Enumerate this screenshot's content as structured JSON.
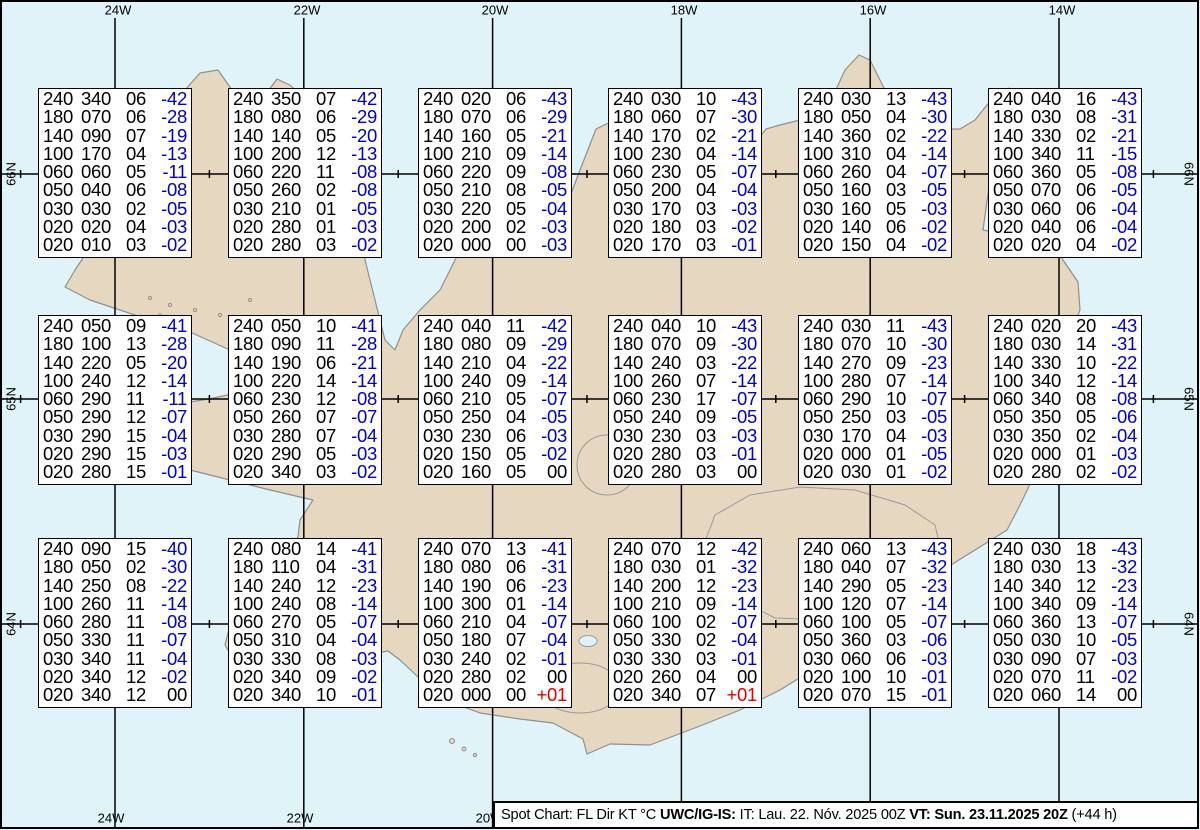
{
  "map": {
    "region_name": "iceland",
    "top_longitude_labels": [
      {
        "text": "24W",
        "x": 118
      },
      {
        "text": "22W",
        "x": 307
      },
      {
        "text": "20W",
        "x": 495
      },
      {
        "text": "18W",
        "x": 684
      },
      {
        "text": "16W",
        "x": 873
      },
      {
        "text": "14W",
        "x": 1062
      }
    ],
    "bottom_longitude_labels": [
      {
        "text": "24W",
        "x": 111
      },
      {
        "text": "22W",
        "x": 300
      },
      {
        "text": "20W",
        "x": 489
      }
    ],
    "left_latitude_labels": [
      {
        "text": "66N",
        "y": 174
      },
      {
        "text": "65N",
        "y": 399
      },
      {
        "text": "64N",
        "y": 624
      }
    ],
    "right_latitude_labels": [
      {
        "text": "66N",
        "y": 174
      },
      {
        "text": "65N",
        "y": 399
      },
      {
        "text": "64N",
        "y": 624
      }
    ],
    "colors": {
      "ocean": "#E0F3F9",
      "land": "#E6D7C1",
      "coastline": "#8F8F8F",
      "grid": "#000000",
      "temp_negative": "#0000CC",
      "temp_positive": "#E00000",
      "text": "#000000"
    }
  },
  "columns_legend": [
    "FL",
    "Dir",
    "KT",
    "°C"
  ],
  "boxes": [
    {
      "col": 0,
      "row": 0,
      "lines": [
        [
          "240",
          "340",
          "06",
          "-42"
        ],
        [
          "180",
          "070",
          "06",
          "-28"
        ],
        [
          "140",
          "090",
          "07",
          "-19"
        ],
        [
          "100",
          "170",
          "04",
          "-13"
        ],
        [
          "060",
          "060",
          "05",
          "-11"
        ],
        [
          "050",
          "040",
          "06",
          "-08"
        ],
        [
          "030",
          "030",
          "02",
          "-05"
        ],
        [
          "020",
          "020",
          "04",
          "-03"
        ],
        [
          "020",
          "010",
          "03",
          "-02"
        ]
      ]
    },
    {
      "col": 1,
      "row": 0,
      "lines": [
        [
          "240",
          "350",
          "07",
          "-42"
        ],
        [
          "180",
          "080",
          "06",
          "-29"
        ],
        [
          "140",
          "140",
          "05",
          "-20"
        ],
        [
          "100",
          "200",
          "12",
          "-13"
        ],
        [
          "060",
          "220",
          "11",
          "-08"
        ],
        [
          "050",
          "260",
          "02",
          "-08"
        ],
        [
          "030",
          "210",
          "01",
          "-05"
        ],
        [
          "020",
          "280",
          "01",
          "-03"
        ],
        [
          "020",
          "280",
          "03",
          "-02"
        ]
      ]
    },
    {
      "col": 2,
      "row": 0,
      "lines": [
        [
          "240",
          "020",
          "06",
          "-43"
        ],
        [
          "180",
          "070",
          "06",
          "-29"
        ],
        [
          "140",
          "160",
          "05",
          "-21"
        ],
        [
          "100",
          "210",
          "09",
          "-14"
        ],
        [
          "060",
          "220",
          "09",
          "-08"
        ],
        [
          "050",
          "210",
          "08",
          "-05"
        ],
        [
          "030",
          "220",
          "05",
          "-04"
        ],
        [
          "020",
          "200",
          "02",
          "-03"
        ],
        [
          "020",
          "000",
          "00",
          "-03"
        ]
      ]
    },
    {
      "col": 3,
      "row": 0,
      "lines": [
        [
          "240",
          "030",
          "10",
          "-43"
        ],
        [
          "180",
          "060",
          "07",
          "-30"
        ],
        [
          "140",
          "170",
          "02",
          "-21"
        ],
        [
          "100",
          "230",
          "04",
          "-14"
        ],
        [
          "060",
          "230",
          "05",
          "-07"
        ],
        [
          "050",
          "200",
          "04",
          "-04"
        ],
        [
          "030",
          "170",
          "03",
          "-03"
        ],
        [
          "020",
          "180",
          "03",
          "-02"
        ],
        [
          "020",
          "170",
          "03",
          "-01"
        ]
      ]
    },
    {
      "col": 4,
      "row": 0,
      "lines": [
        [
          "240",
          "030",
          "13",
          "-43"
        ],
        [
          "180",
          "050",
          "04",
          "-30"
        ],
        [
          "140",
          "360",
          "02",
          "-22"
        ],
        [
          "100",
          "310",
          "04",
          "-14"
        ],
        [
          "060",
          "260",
          "04",
          "-07"
        ],
        [
          "050",
          "160",
          "03",
          "-05"
        ],
        [
          "030",
          "160",
          "05",
          "-03"
        ],
        [
          "020",
          "140",
          "06",
          "-02"
        ],
        [
          "020",
          "150",
          "04",
          "-02"
        ]
      ]
    },
    {
      "col": 5,
      "row": 0,
      "lines": [
        [
          "240",
          "040",
          "16",
          "-43"
        ],
        [
          "180",
          "030",
          "08",
          "-31"
        ],
        [
          "140",
          "330",
          "02",
          "-21"
        ],
        [
          "100",
          "340",
          "11",
          "-15"
        ],
        [
          "060",
          "360",
          "05",
          "-08"
        ],
        [
          "050",
          "070",
          "06",
          "-05"
        ],
        [
          "030",
          "060",
          "06",
          "-04"
        ],
        [
          "020",
          "040",
          "06",
          "-04"
        ],
        [
          "020",
          "020",
          "04",
          "-02"
        ]
      ]
    },
    {
      "col": 0,
      "row": 1,
      "lines": [
        [
          "240",
          "050",
          "09",
          "-41"
        ],
        [
          "180",
          "100",
          "13",
          "-28"
        ],
        [
          "140",
          "220",
          "05",
          "-20"
        ],
        [
          "100",
          "240",
          "12",
          "-14"
        ],
        [
          "060",
          "290",
          "11",
          "-11"
        ],
        [
          "050",
          "290",
          "12",
          "-07"
        ],
        [
          "030",
          "290",
          "15",
          "-04"
        ],
        [
          "020",
          "290",
          "15",
          "-03"
        ],
        [
          "020",
          "280",
          "15",
          "-01"
        ]
      ]
    },
    {
      "col": 1,
      "row": 1,
      "lines": [
        [
          "240",
          "050",
          "10",
          "-41"
        ],
        [
          "180",
          "090",
          "11",
          "-28"
        ],
        [
          "140",
          "190",
          "06",
          "-21"
        ],
        [
          "100",
          "220",
          "14",
          "-14"
        ],
        [
          "060",
          "230",
          "12",
          "-08"
        ],
        [
          "050",
          "260",
          "07",
          "-07"
        ],
        [
          "030",
          "280",
          "07",
          "-04"
        ],
        [
          "020",
          "290",
          "05",
          "-03"
        ],
        [
          "020",
          "340",
          "03",
          "-02"
        ]
      ]
    },
    {
      "col": 2,
      "row": 1,
      "lines": [
        [
          "240",
          "040",
          "11",
          "-42"
        ],
        [
          "180",
          "080",
          "09",
          "-29"
        ],
        [
          "140",
          "210",
          "04",
          "-22"
        ],
        [
          "100",
          "240",
          "09",
          "-14"
        ],
        [
          "060",
          "210",
          "05",
          "-07"
        ],
        [
          "050",
          "250",
          "04",
          "-05"
        ],
        [
          "030",
          "230",
          "06",
          "-03"
        ],
        [
          "020",
          "150",
          "05",
          "-02"
        ],
        [
          "020",
          "160",
          "05",
          "00"
        ]
      ]
    },
    {
      "col": 3,
      "row": 1,
      "lines": [
        [
          "240",
          "040",
          "10",
          "-43"
        ],
        [
          "180",
          "070",
          "09",
          "-30"
        ],
        [
          "140",
          "240",
          "03",
          "-22"
        ],
        [
          "100",
          "260",
          "07",
          "-14"
        ],
        [
          "060",
          "230",
          "17",
          "-07"
        ],
        [
          "050",
          "240",
          "09",
          "-05"
        ],
        [
          "030",
          "230",
          "03",
          "-03"
        ],
        [
          "020",
          "280",
          "03",
          "-01"
        ],
        [
          "020",
          "280",
          "03",
          "00"
        ]
      ]
    },
    {
      "col": 4,
      "row": 1,
      "lines": [
        [
          "240",
          "030",
          "11",
          "-43"
        ],
        [
          "180",
          "070",
          "10",
          "-30"
        ],
        [
          "140",
          "270",
          "09",
          "-23"
        ],
        [
          "100",
          "280",
          "07",
          "-14"
        ],
        [
          "060",
          "290",
          "10",
          "-07"
        ],
        [
          "050",
          "250",
          "03",
          "-05"
        ],
        [
          "030",
          "170",
          "04",
          "-03"
        ],
        [
          "020",
          "000",
          "01",
          "-05"
        ],
        [
          "020",
          "030",
          "01",
          "-02"
        ]
      ]
    },
    {
      "col": 5,
      "row": 1,
      "lines": [
        [
          "240",
          "020",
          "20",
          "-43"
        ],
        [
          "180",
          "030",
          "14",
          "-31"
        ],
        [
          "140",
          "330",
          "10",
          "-22"
        ],
        [
          "100",
          "340",
          "12",
          "-14"
        ],
        [
          "060",
          "340",
          "08",
          "-08"
        ],
        [
          "050",
          "350",
          "05",
          "-06"
        ],
        [
          "030",
          "350",
          "02",
          "-04"
        ],
        [
          "020",
          "000",
          "01",
          "-03"
        ],
        [
          "020",
          "280",
          "02",
          "-02"
        ]
      ]
    },
    {
      "col": 0,
      "row": 2,
      "lines": [
        [
          "240",
          "090",
          "15",
          "-40"
        ],
        [
          "180",
          "050",
          "02",
          "-30"
        ],
        [
          "140",
          "250",
          "08",
          "-22"
        ],
        [
          "100",
          "260",
          "11",
          "-14"
        ],
        [
          "060",
          "280",
          "11",
          "-08"
        ],
        [
          "050",
          "330",
          "11",
          "-07"
        ],
        [
          "030",
          "340",
          "11",
          "-04"
        ],
        [
          "020",
          "340",
          "12",
          "-02"
        ],
        [
          "020",
          "340",
          "12",
          "00"
        ]
      ]
    },
    {
      "col": 1,
      "row": 2,
      "lines": [
        [
          "240",
          "080",
          "14",
          "-41"
        ],
        [
          "180",
          "110",
          "04",
          "-31"
        ],
        [
          "140",
          "240",
          "12",
          "-23"
        ],
        [
          "100",
          "240",
          "08",
          "-14"
        ],
        [
          "060",
          "270",
          "05",
          "-07"
        ],
        [
          "050",
          "310",
          "04",
          "-04"
        ],
        [
          "030",
          "330",
          "08",
          "-03"
        ],
        [
          "020",
          "340",
          "09",
          "-02"
        ],
        [
          "020",
          "340",
          "10",
          "-01"
        ]
      ]
    },
    {
      "col": 2,
      "row": 2,
      "lines": [
        [
          "240",
          "070",
          "13",
          "-41"
        ],
        [
          "180",
          "080",
          "06",
          "-31"
        ],
        [
          "140",
          "190",
          "06",
          "-23"
        ],
        [
          "100",
          "300",
          "01",
          "-14"
        ],
        [
          "060",
          "210",
          "04",
          "-07"
        ],
        [
          "050",
          "180",
          "07",
          "-04"
        ],
        [
          "030",
          "240",
          "02",
          "-01"
        ],
        [
          "020",
          "280",
          "02",
          "00"
        ],
        [
          "020",
          "000",
          "00",
          "+01"
        ]
      ]
    },
    {
      "col": 3,
      "row": 2,
      "lines": [
        [
          "240",
          "070",
          "12",
          "-42"
        ],
        [
          "180",
          "030",
          "01",
          "-32"
        ],
        [
          "140",
          "200",
          "12",
          "-23"
        ],
        [
          "100",
          "210",
          "09",
          "-14"
        ],
        [
          "060",
          "100",
          "02",
          "-07"
        ],
        [
          "050",
          "330",
          "02",
          "-04"
        ],
        [
          "030",
          "330",
          "03",
          "-01"
        ],
        [
          "020",
          "260",
          "04",
          "00"
        ],
        [
          "020",
          "340",
          "07",
          "+01"
        ]
      ]
    },
    {
      "col": 4,
      "row": 2,
      "lines": [
        [
          "240",
          "060",
          "13",
          "-43"
        ],
        [
          "180",
          "040",
          "07",
          "-32"
        ],
        [
          "140",
          "290",
          "05",
          "-23"
        ],
        [
          "100",
          "120",
          "07",
          "-14"
        ],
        [
          "060",
          "100",
          "05",
          "-07"
        ],
        [
          "050",
          "360",
          "03",
          "-06"
        ],
        [
          "030",
          "060",
          "06",
          "-03"
        ],
        [
          "020",
          "100",
          "10",
          "-01"
        ],
        [
          "020",
          "070",
          "15",
          "-01"
        ]
      ]
    },
    {
      "col": 5,
      "row": 2,
      "lines": [
        [
          "240",
          "030",
          "18",
          "-43"
        ],
        [
          "180",
          "030",
          "13",
          "-32"
        ],
        [
          "140",
          "340",
          "12",
          "-23"
        ],
        [
          "100",
          "340",
          "09",
          "-14"
        ],
        [
          "060",
          "360",
          "13",
          "-07"
        ],
        [
          "050",
          "030",
          "10",
          "-05"
        ],
        [
          "030",
          "090",
          "07",
          "-03"
        ],
        [
          "020",
          "070",
          "11",
          "-02"
        ],
        [
          "020",
          "060",
          "14",
          "00"
        ]
      ]
    }
  ],
  "footer": {
    "segments": [
      {
        "text": "Spot Chart: FL Dir KT °C ",
        "bold": false
      },
      {
        "text": "UWC/IG-IS:",
        "bold": true
      },
      {
        "text": " IT: Lau. 22. Nóv. 2025 00Z ",
        "bold": false
      },
      {
        "text": "VT: Sun. 23.11.2025 20Z",
        "bold": true
      },
      {
        "text": " (+44 h)",
        "bold": false
      }
    ]
  }
}
